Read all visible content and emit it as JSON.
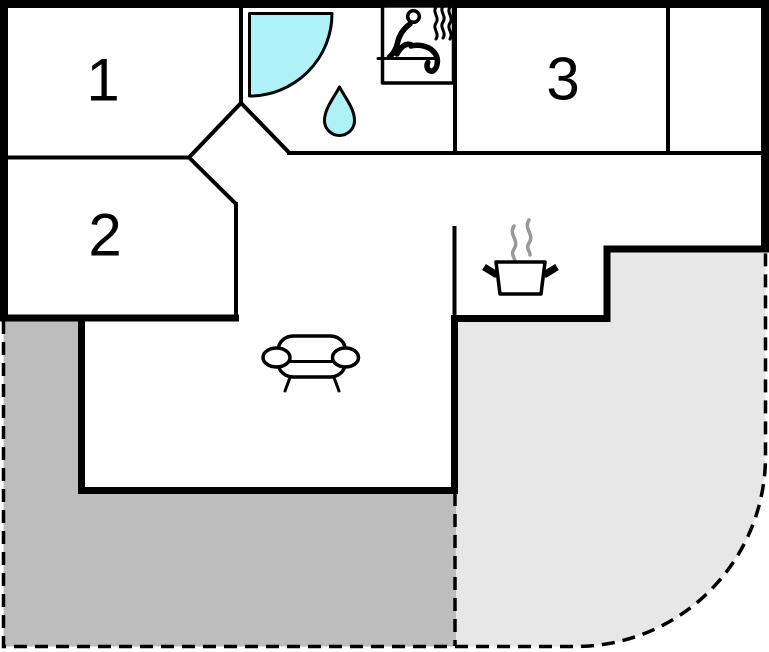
{
  "plan": {
    "type": "floor-plan",
    "rooms": [
      {
        "name": "bedroom-1",
        "label": "1"
      },
      {
        "name": "bedroom-2",
        "label": "2"
      },
      {
        "name": "room-3",
        "label": "3"
      }
    ],
    "icons": [
      {
        "name": "shower-icon"
      },
      {
        "name": "water-drop-icon"
      },
      {
        "name": "sauna-icon"
      },
      {
        "name": "cooking-pot-icon"
      },
      {
        "name": "sofa-icon"
      }
    ],
    "colors": {
      "wall": "#000000",
      "floor": "#ffffff",
      "water_feature": "#aef1f7",
      "terrace_dark": "#bdbdbd",
      "terrace_light": "#e7e7e7",
      "steam_gray": "#999999"
    }
  }
}
